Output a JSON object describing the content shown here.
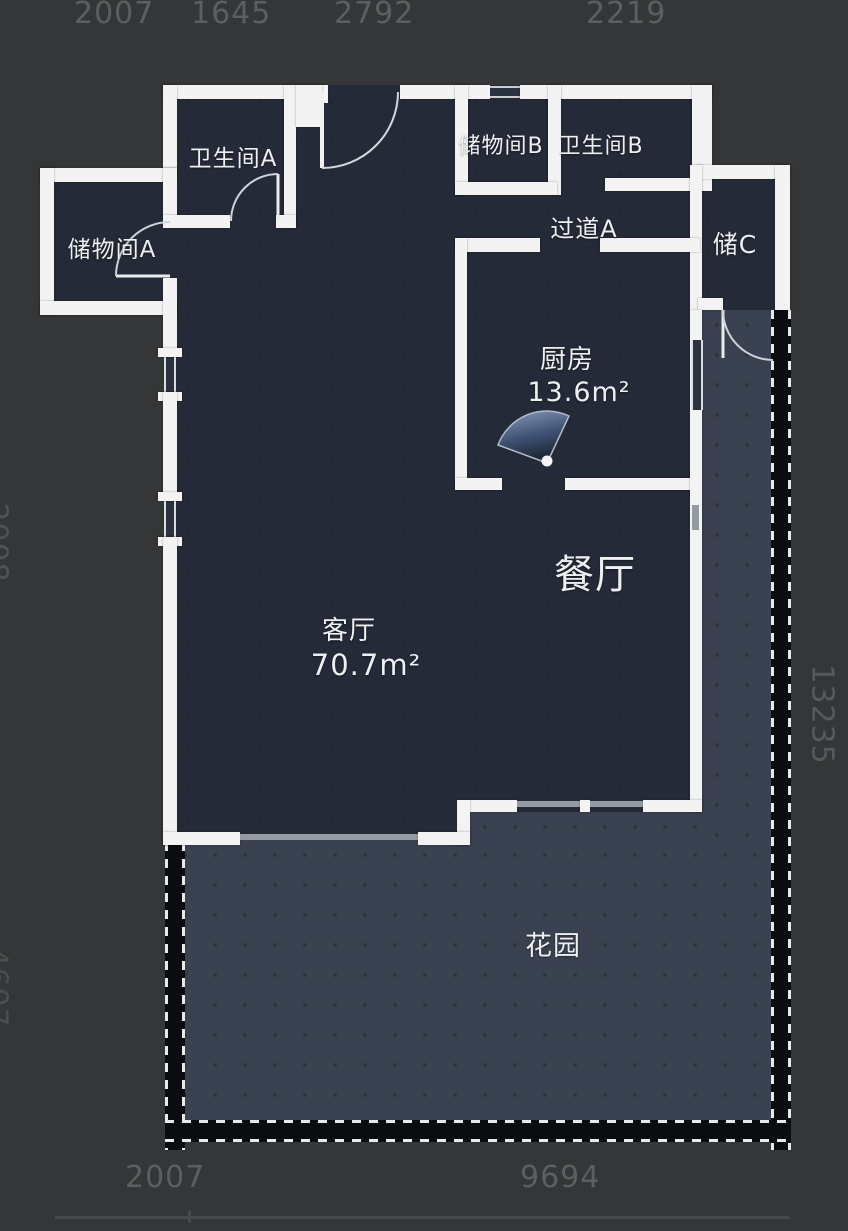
{
  "app": {
    "type": "floor-plan-viewer"
  },
  "rooms": {
    "bathroom_a": {
      "label": "卫生间A"
    },
    "storage_b": {
      "label": "储物间B"
    },
    "bathroom_b": {
      "label": "卫生间B"
    },
    "hallway_a": {
      "label": "过道A"
    },
    "storage_a": {
      "label": "储物间A"
    },
    "storage_c": {
      "label": "储C"
    },
    "kitchen": {
      "label": "厨房",
      "area": "13.6m²"
    },
    "dining": {
      "label": "餐厅"
    },
    "living": {
      "label": "客厅",
      "area": "70.7m²"
    },
    "garden": {
      "label": "花园"
    }
  },
  "dimensions": {
    "top": [
      "2007",
      "1645",
      "2792",
      "2219"
    ],
    "right": "13235",
    "left_partial": [
      "2008",
      "4607"
    ],
    "bottom": [
      "2007",
      "9694"
    ]
  },
  "icons": {
    "kitchen_fan": "fan-sensor-icon"
  },
  "colors": {
    "background": "#343637",
    "interior": "#242a37",
    "garden": "#3a4150",
    "wall": "#f3f3f3",
    "dimension_text": "#5c5e60",
    "label_text": "#edeff1",
    "fan_blue": "#6d87b0"
  }
}
